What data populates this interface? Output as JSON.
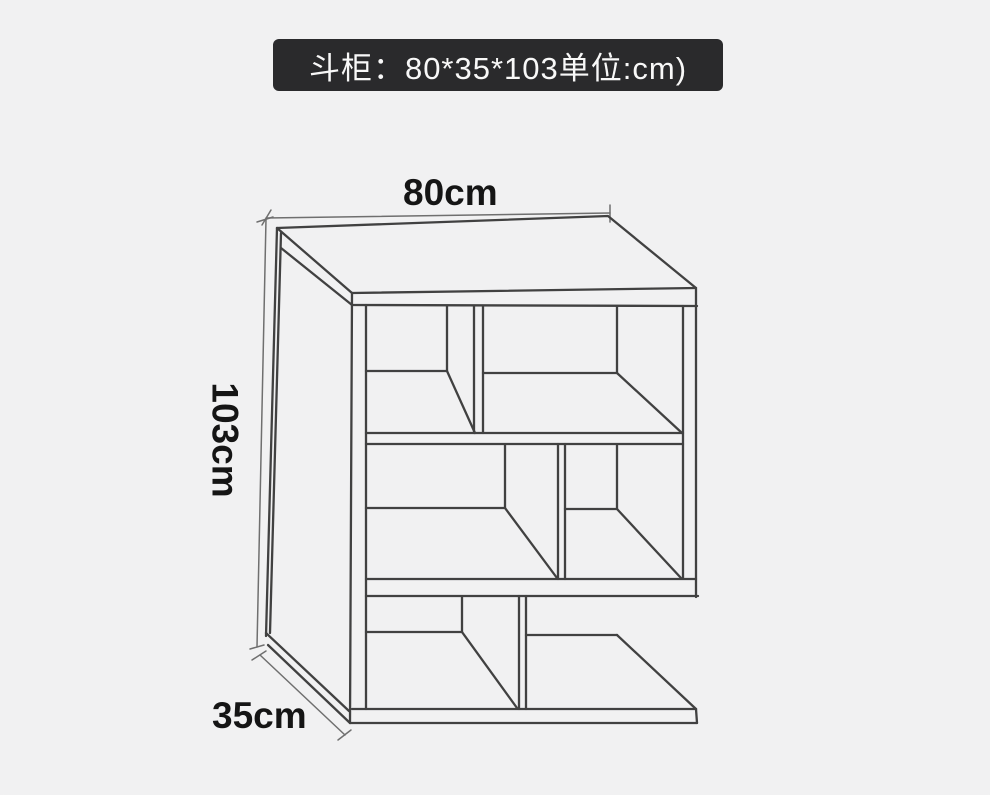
{
  "banner": {
    "text": "斗柜：80*35*103单位:cm)"
  },
  "labels": {
    "width": "80cm",
    "height": "103cm",
    "depth": "35cm"
  },
  "colors": {
    "page-bg": "#f1f1f2",
    "banner-bg": "#2a2a2c",
    "banner-text": "#f8f8f8",
    "sketch-line": "#414141",
    "dim-line": "#6f6f6f",
    "label-text": "#151515"
  }
}
